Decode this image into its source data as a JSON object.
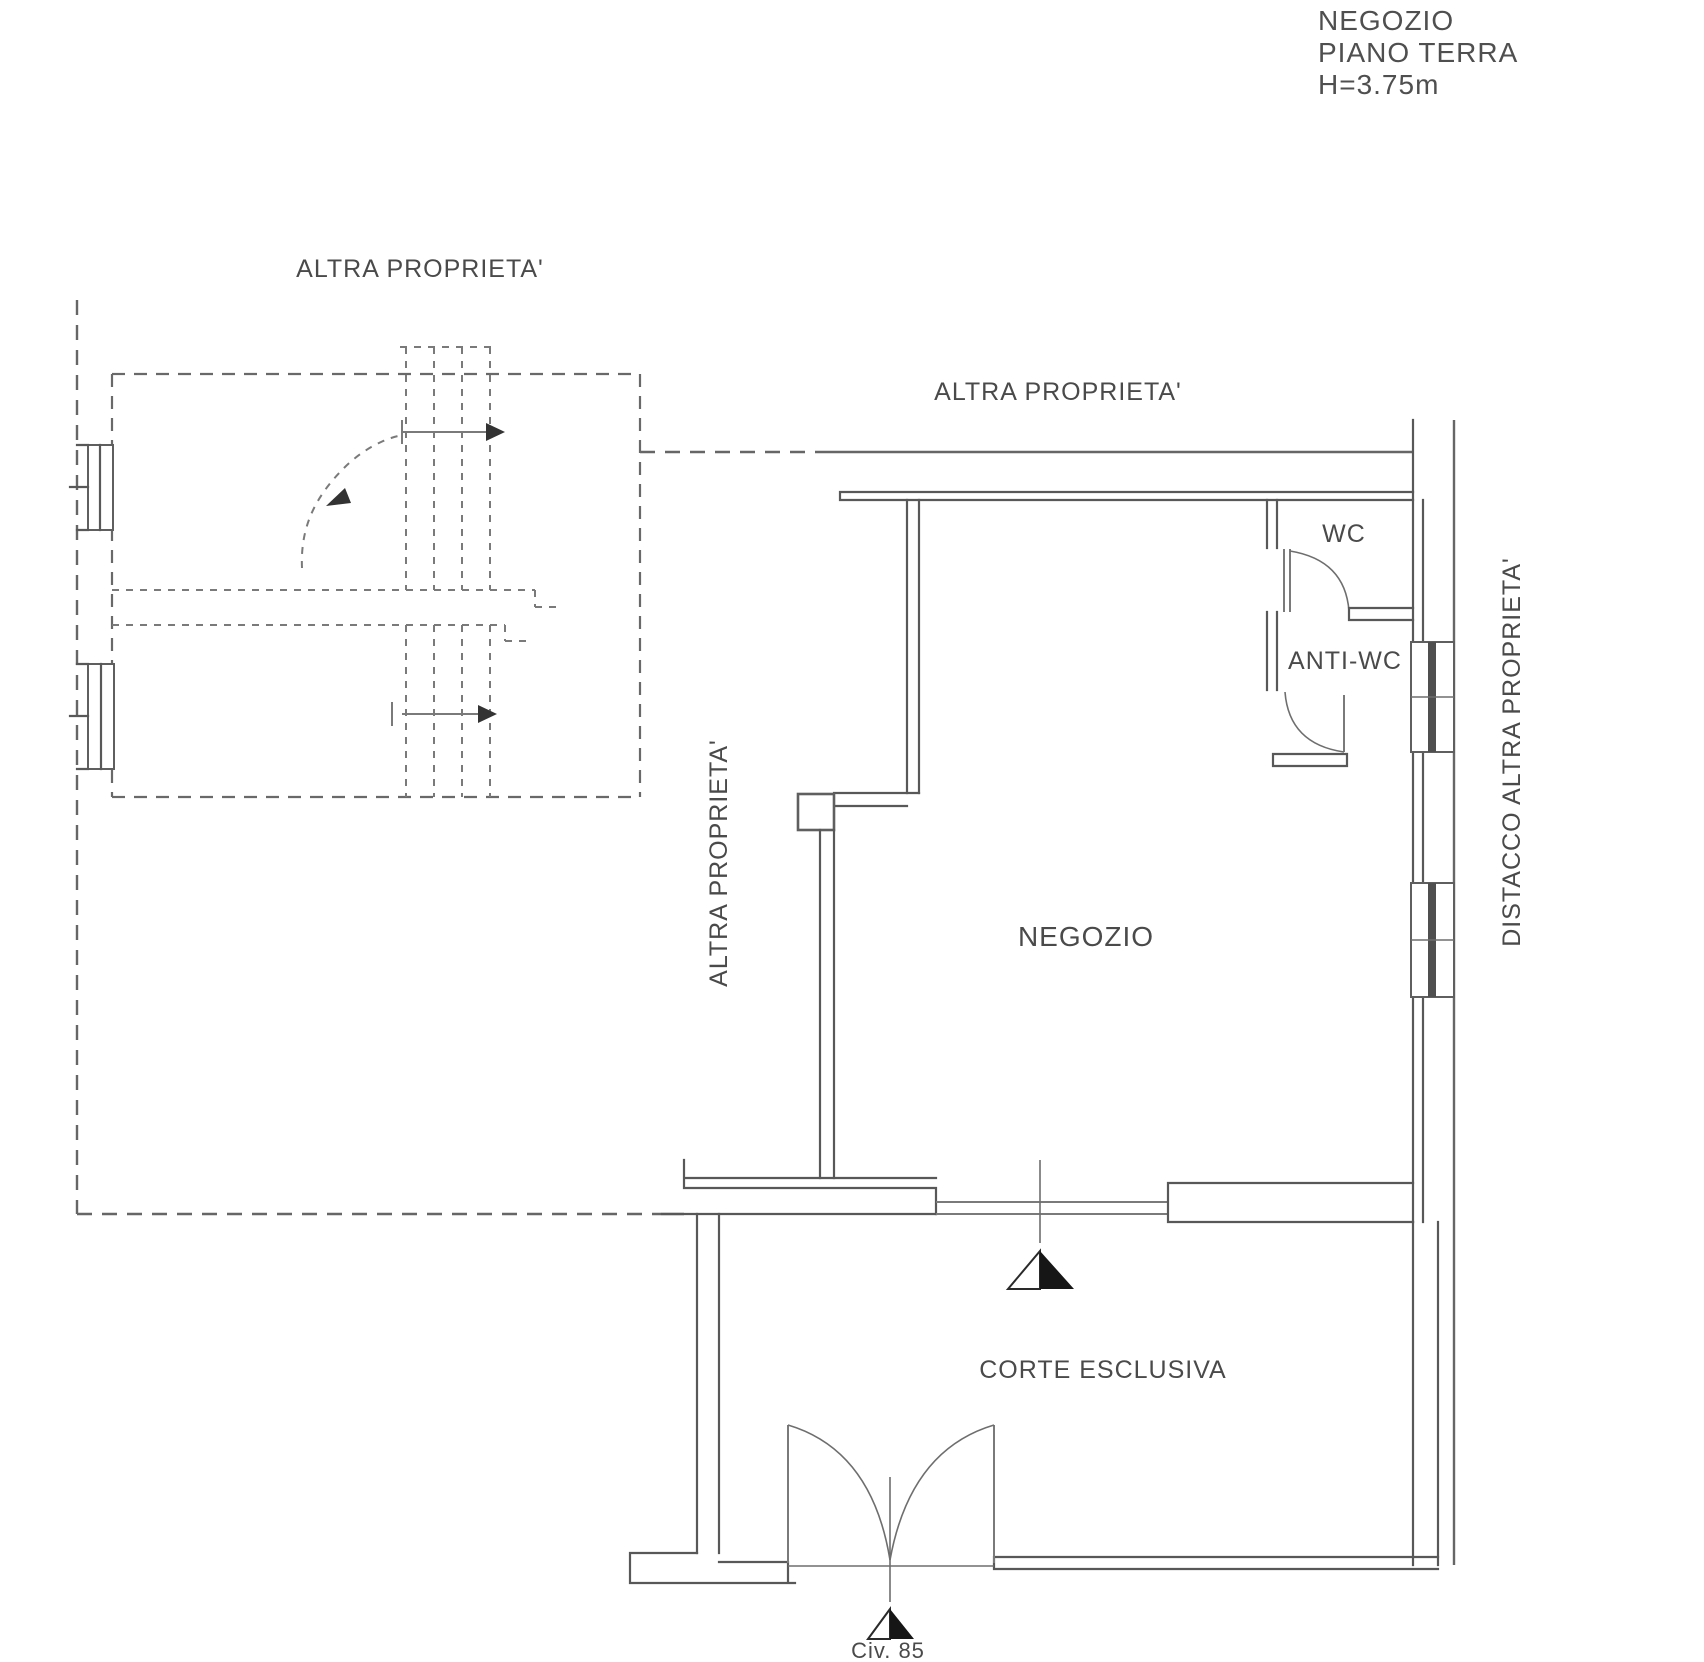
{
  "title_block": {
    "building": "NEGOZIO",
    "floor": "PIANO TERRA",
    "height": "H=3.75m"
  },
  "labels": {
    "altra_proprieta_top_left": "ALTRA PROPRIETA'",
    "altra_proprieta_top_center": "ALTRA PROPRIETA'",
    "altra_proprieta_left_vertical": "ALTRA PROPRIETA'",
    "distacco_right_vertical": "DISTACCO ALTRA PROPRIETA'",
    "wc": "WC",
    "anti_wc": "ANTI-WC",
    "negozio": "NEGOZIO",
    "corte_esclusiva": "CORTE ESCLUSIVA",
    "civic_number": "Civ. 85"
  },
  "colors": {
    "background": "#ffffff",
    "wall": "#585858",
    "boundary_dashed": "#666666",
    "thin_line": "#7a7a7a",
    "text": "#4a4a4a",
    "entrance_marker": "#161616"
  }
}
